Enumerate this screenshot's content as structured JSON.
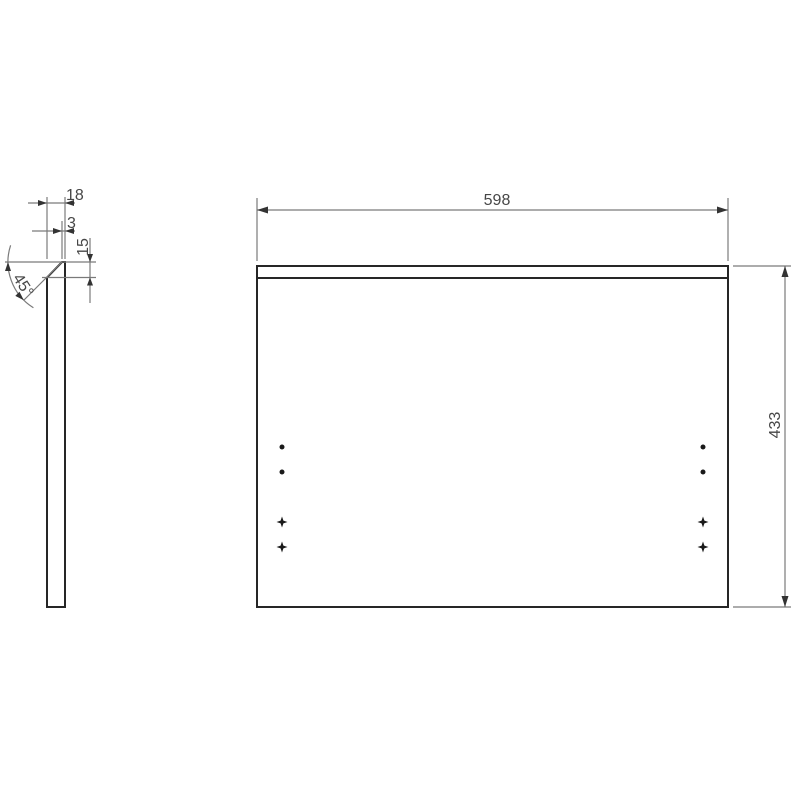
{
  "drawing": {
    "side_view": {
      "thickness_label": "18",
      "flat_label": "3",
      "chamfer_label": "15",
      "angle_label": "45°"
    },
    "front_view": {
      "width_label": "598",
      "height_label": "433"
    }
  }
}
